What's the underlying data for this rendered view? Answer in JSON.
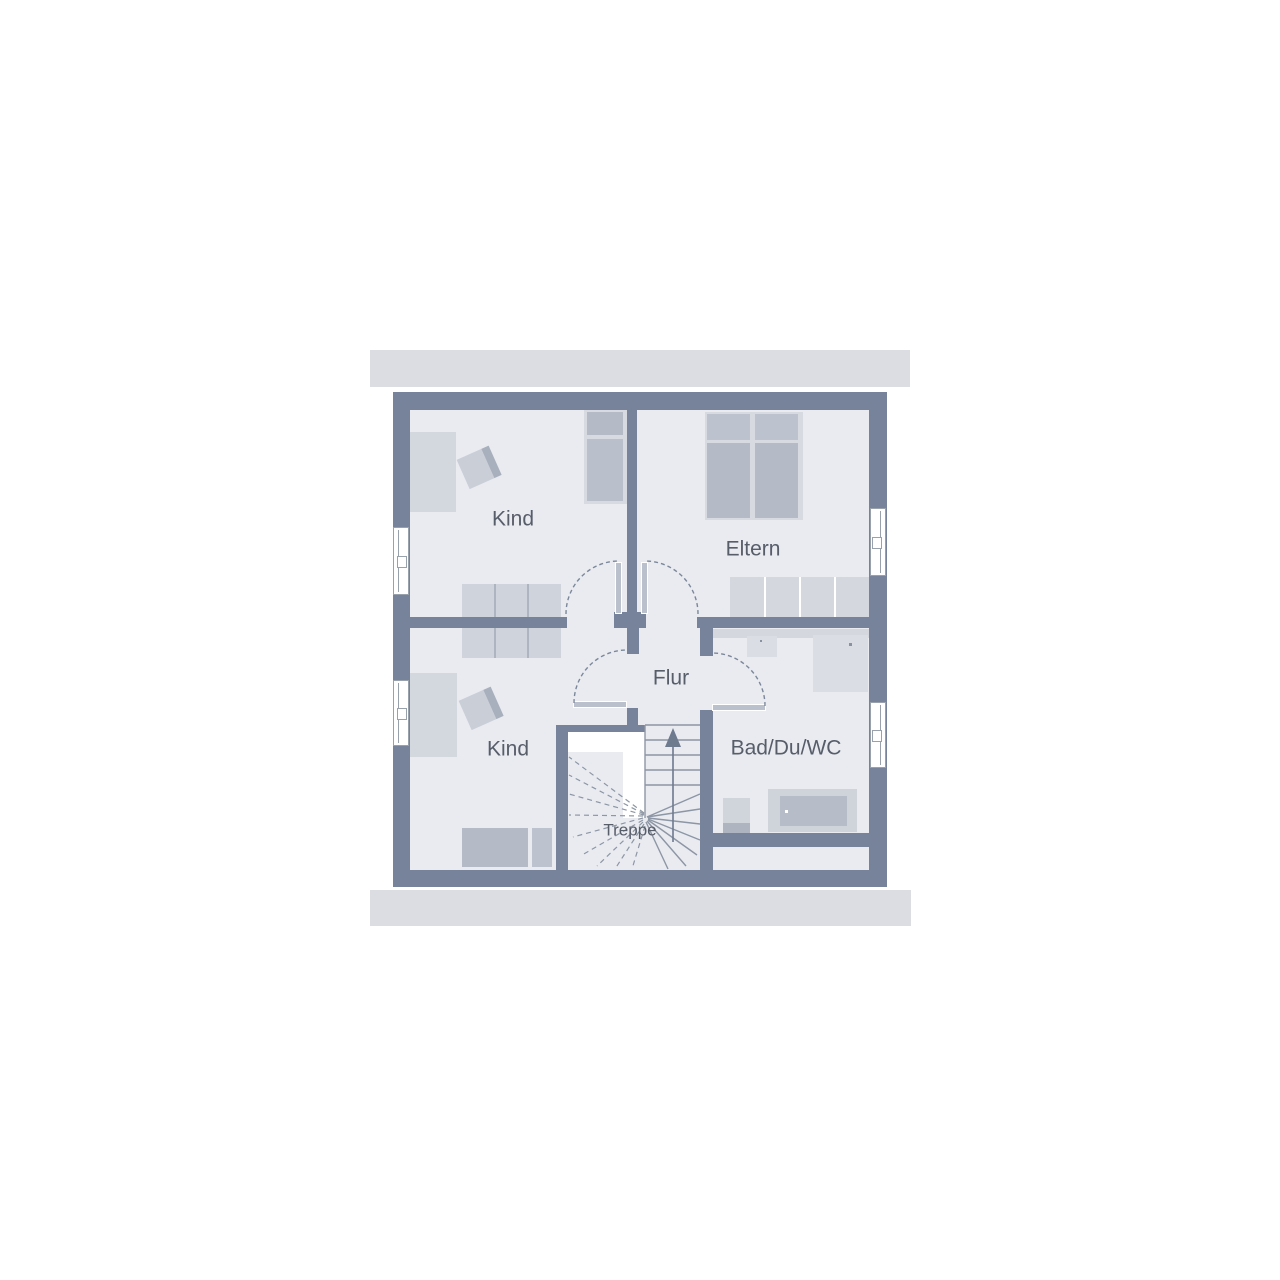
{
  "plan": {
    "type": "floor-plan",
    "floor_name": "Dachgeschoss",
    "rooms": [
      {
        "id": "kind-upper",
        "label": "Kind"
      },
      {
        "id": "eltern",
        "label": "Eltern"
      },
      {
        "id": "kind-lower",
        "label": "Kind"
      },
      {
        "id": "flur",
        "label": "Flur"
      },
      {
        "id": "treppe",
        "label": "Treppe"
      },
      {
        "id": "bad",
        "label": "Bad/Du/WC"
      }
    ],
    "colors": {
      "wall": "#76839a",
      "floor": "#e9ebf1",
      "roof": "#dbdde2",
      "white": "#ffffff",
      "furnLight": "#d3d7de",
      "wardrobe": "#cfd4dc",
      "wardrobeDiv": "#aeb5c1",
      "elternWardrobe": "#d4d7de",
      "bedDark": "#b4bbc7",
      "pillow": "#bdc3ce",
      "bedFrame": "#d7dae1",
      "doorLeaf": "#bac1cc",
      "dash": "#7c8899",
      "stair": "#8d96a4",
      "arrow": "#6e7a8e",
      "text": "#575d69",
      "band": "#d4d8de",
      "fixture": "#dadde3",
      "fixtureDark": "#b7bdc8",
      "seat": "#c9ced7",
      "seatBack": "#a9b0bd",
      "frameLine": "#99a1ad"
    }
  }
}
